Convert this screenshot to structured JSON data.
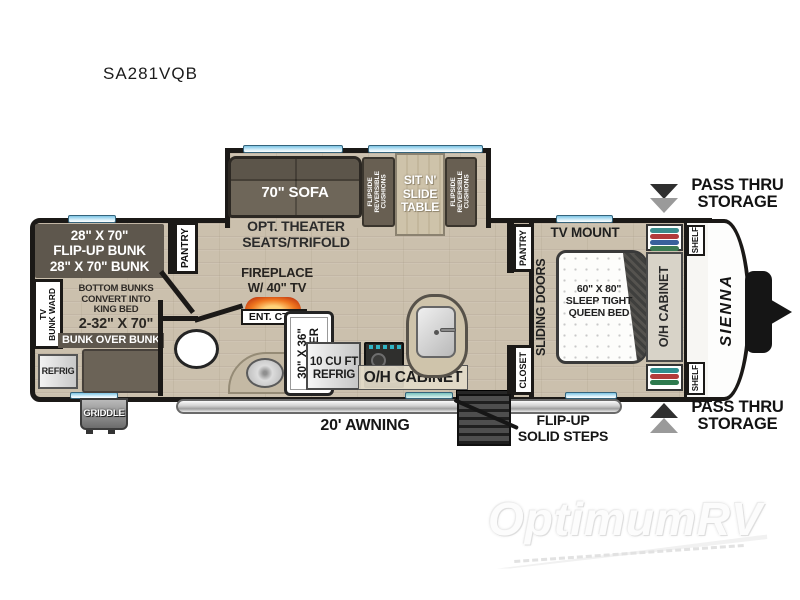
{
  "title": "SA281VQB",
  "watermark": {
    "brand": "OptimumRV"
  },
  "exterior": {
    "pass_thru_top": "PASS THRU\nSTORAGE",
    "pass_thru_bottom": "PASS THRU\nSTORAGE",
    "awning": "20' AWNING",
    "steps": "FLIP-UP\nSOLID STEPS",
    "griddle": "GRIDDLE",
    "brand_logo": "SIENNA"
  },
  "bunk_room": {
    "flip_up_bunk": "28\" X 70\"\nFLIP-UP BUNK\n28\" X 70\" BUNK",
    "tv_bunk_ward": "TV\nBUNK WARD",
    "bottom_bunks": "BOTTOM BUNKS\nCONVERT INTO\nKING BED",
    "bunk_size": "2-32\" X 70\"",
    "bunk_over_bunk": "BUNK OVER BUNK",
    "refrig": "REFRIG"
  },
  "living": {
    "pantry": "PANTRY",
    "sofa": "70\" SOFA",
    "theater": "OPT. THEATER\nSEATS/TRIFOLD",
    "cushions_left": "FLIPSIDE\nREVERSIBLE\nCUSHIONS",
    "table": "SIT N'\nSLIDE\nTABLE",
    "cushions_right": "FLIPSIDE\nREVERSIBLE\nCUSHIONS",
    "fireplace": "FIREPLACE\nW/ 40\" TV",
    "ent_ctr": "ENT. CTR."
  },
  "bath": {
    "shower": "30\" X 36\"\nSHOWER"
  },
  "kitchen": {
    "refrig": "10 CU FT\nREFRIG",
    "oh_cabinet": "O/H CABINET"
  },
  "bedroom": {
    "pantry": "PANTRY",
    "tv_mount": "TV MOUNT",
    "sliding_doors": "SLIDING DOORS",
    "bed": "60\" X 80\"\nSLEEP TIGHT\nQUEEN BED",
    "closet": "CLOSET",
    "oh_cabinet": "O/H CABINET",
    "shelf_top": "SHELF",
    "shelf_bottom": "SHELF"
  },
  "colors": {
    "wall": "#1b1917",
    "floor": "#cbc0ad",
    "dark_furniture": "#5e574d",
    "window_blue": "#7cc4e4",
    "fire_orange": "#e8701f"
  }
}
